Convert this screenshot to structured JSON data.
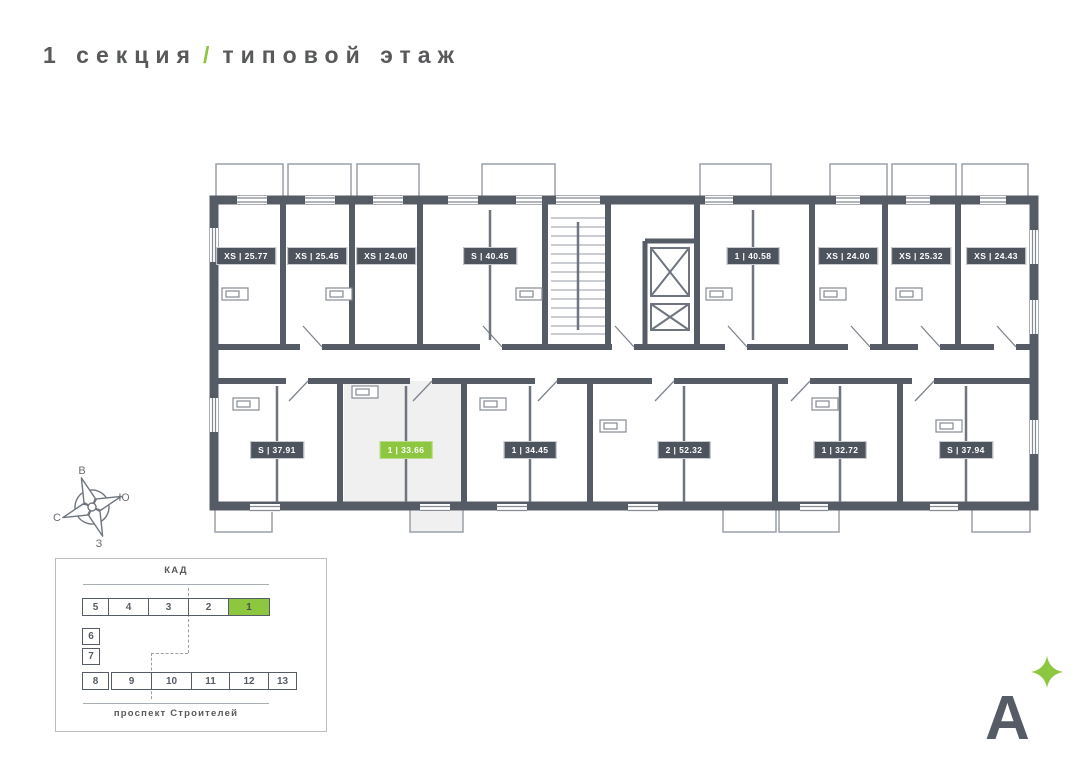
{
  "title": {
    "section": "1 секция",
    "slash": "/",
    "floor": "типовой этаж"
  },
  "colors": {
    "accent_green": "#8DC63F",
    "wall": "#565C66",
    "badge_dark": "#4E545E",
    "text_dark": "#58595B",
    "selected_fill": "#F0F0F1"
  },
  "apartments": {
    "top": [
      {
        "type": "XS",
        "area": "25.77",
        "label": "XS | 25.77"
      },
      {
        "type": "XS",
        "area": "25.45",
        "label": "XS | 25.45"
      },
      {
        "type": "XS",
        "area": "24.00",
        "label": "XS | 24.00"
      },
      {
        "type": "S",
        "area": "40.45",
        "label": "S | 40.45"
      },
      {
        "type": "1",
        "area": "40.58",
        "label": "1 | 40.58"
      },
      {
        "type": "XS",
        "area": "24.00",
        "label": "XS | 24.00"
      },
      {
        "type": "XS",
        "area": "25.32",
        "label": "XS | 25.32"
      },
      {
        "type": "XS",
        "area": "24.43",
        "label": "XS | 24.43"
      }
    ],
    "bottom": [
      {
        "type": "S",
        "area": "37.91",
        "label": "S | 37.91"
      },
      {
        "type": "1",
        "area": "33.66",
        "label": "1 | 33.66",
        "highlighted": true
      },
      {
        "type": "1",
        "area": "34.45",
        "label": "1 | 34.45"
      },
      {
        "type": "2",
        "area": "52.32",
        "label": "2 | 52.32"
      },
      {
        "type": "1",
        "area": "32.72",
        "label": "1 | 32.72"
      },
      {
        "type": "S",
        "area": "37.94",
        "label": "S | 37.94"
      }
    ]
  },
  "compass": {
    "top": "В",
    "right": "Ю",
    "left": "С",
    "bottom": "З"
  },
  "minimap": {
    "road_top": "КАД",
    "road_bottom": "проспект Строителей",
    "sections_top": [
      "5",
      "4",
      "3",
      "2",
      "1"
    ],
    "sections_left": [
      "6",
      "7"
    ],
    "sections_bottom": [
      "8",
      "9",
      "10",
      "11",
      "12",
      "13"
    ],
    "selected_section": "1"
  },
  "logo": {
    "letter": "А"
  }
}
